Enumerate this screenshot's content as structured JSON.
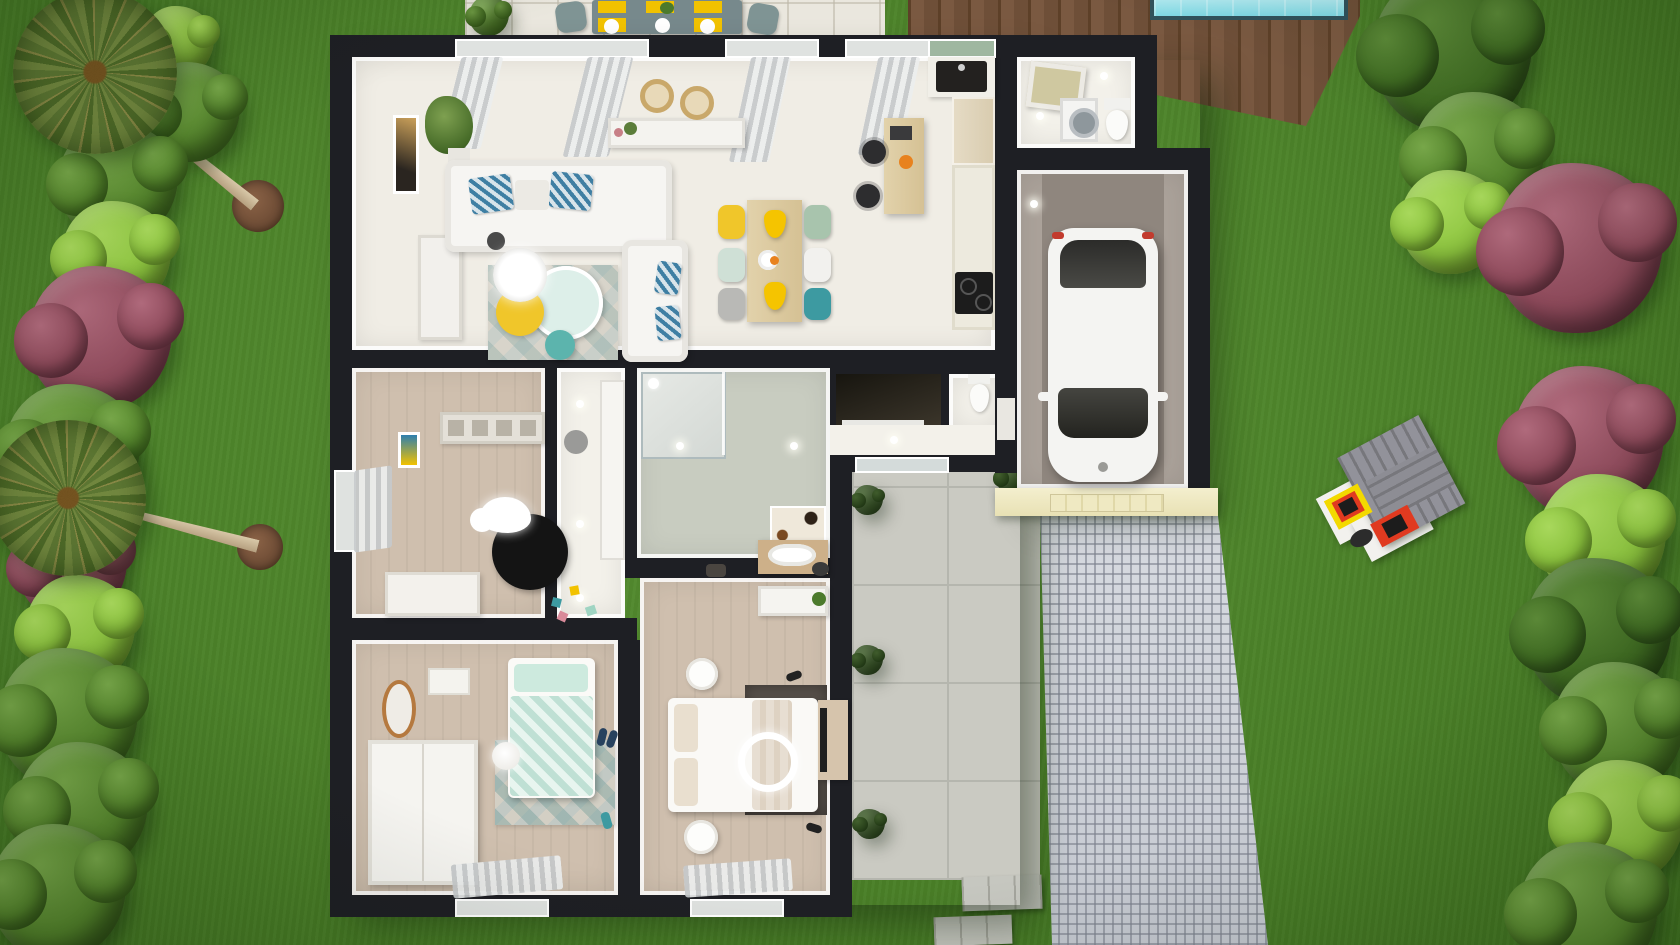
{
  "scene": {
    "type": "3d-floorplan-aerial-render",
    "palette": {
      "grass": "#4d8a26",
      "wall": "#1e1f24",
      "floor_white": "#f0ede5",
      "floor_wood": "#cfbfae",
      "floor_bath": "#c8ccc0",
      "garage_floor": "#a79e96",
      "terrace": "#cacac2",
      "cobble": "#ccd0d7",
      "deck": "#7a5941",
      "pool": "#85dbe7",
      "cream_facade": "#f1ecca",
      "accent_yellow": "#f2c200",
      "accent_teal": "#3f9aa1",
      "accent_mint": "#bfe0d4",
      "rug_dark": "#57504a",
      "rug_black": "#141414",
      "tree_light": "#8cc43e",
      "tree_green": "#55862c",
      "tree_dark": "#3f6b22",
      "tree_red": "#8e4a5b",
      "palm": "#67803a",
      "mulch": "#6f4d36",
      "car": "#f4f4f2",
      "playhouse_roof": "#8b8b90",
      "playhouse_window": "#f3d900",
      "playhouse_door": "#e03a20"
    },
    "house": {
      "wall_color": "#1e1f24",
      "rooms": [
        {
          "name": "living-room",
          "floor": "#f0ede5",
          "items": [
            "sofa",
            "sofa-2",
            "rug",
            "coffee-tables",
            "wall-shelf",
            "plant",
            "picture"
          ]
        },
        {
          "name": "dining-area",
          "floor": "#f0ede5",
          "items": [
            "wood-table",
            "6-chairs",
            "yellow-pendants",
            "console"
          ]
        },
        {
          "name": "kitchen",
          "floor": "#f0ede5",
          "items": [
            "black-sink",
            "counter",
            "cooktop",
            "desk",
            "office-chairs"
          ]
        },
        {
          "name": "laundry",
          "floor": "#efede8",
          "items": [
            "washing-machine",
            "toilet",
            "skylight"
          ]
        },
        {
          "name": "garage",
          "floor": "#a79e96",
          "items": [
            "white-car"
          ]
        },
        {
          "name": "entry-hall",
          "floor": "#f3f1ea",
          "items": [
            "glass-door"
          ]
        },
        {
          "name": "cellar",
          "floor": "#2a2620",
          "items": [
            "sliding-door"
          ]
        },
        {
          "name": "wc",
          "floor": "#e9e7e1",
          "items": [
            "toilet"
          ]
        },
        {
          "name": "corridor",
          "floor": "#f2f0ea",
          "items": [
            "closet"
          ]
        },
        {
          "name": "kids-bedroom",
          "floor": "#cfbfae",
          "items": [
            "black-round-rug",
            "cloud-crib",
            "dresser",
            "toys",
            "shelf"
          ]
        },
        {
          "name": "bathroom",
          "floor": "#c8ccc0",
          "items": [
            "shower",
            "vanity",
            "art-panel"
          ]
        },
        {
          "name": "bedroom",
          "floor": "#cfbfae",
          "items": [
            "mint-bed",
            "triangle-rug",
            "wardrobe",
            "copper-mirror"
          ]
        },
        {
          "name": "master-bedroom",
          "floor": "#cfbfae",
          "items": [
            "double-bed",
            "dark-rug",
            "tv-stand",
            "nightstands",
            "console"
          ]
        }
      ]
    },
    "exterior": {
      "patio_dining": {
        "table": "#77898c",
        "placemats": 6,
        "placemat_color": "#f2c200",
        "plates": "#ffffff",
        "chairs": "#7f9494"
      },
      "pool": {
        "water": "#85dbe7",
        "coping": "#30525c"
      },
      "deck": {
        "color": "#7a5941"
      },
      "driveway": {
        "style": "cobblestone",
        "color": "#ccd0d7"
      },
      "playhouse": {
        "roof": "#8b8b90",
        "walls": "#ffffff",
        "window": "#f3d900",
        "door": "#e03a20"
      },
      "car": {
        "color": "#f4f4f2",
        "location": "garage"
      }
    },
    "palms": [
      {
        "x": 95,
        "y": 72,
        "r": 82
      },
      {
        "x": 68,
        "y": 498,
        "r": 78
      }
    ],
    "trunks": [
      {
        "x1": 100,
        "y1": 80,
        "x2": 255,
        "y2": 205
      },
      {
        "x1": 75,
        "y1": 498,
        "x2": 258,
        "y2": 546
      }
    ],
    "mulch": [
      {
        "x": 258,
        "y": 206,
        "r": 26
      },
      {
        "x": 260,
        "y": 547,
        "r": 23
      }
    ],
    "trees": [
      {
        "type": "light",
        "x": 178,
        "y": 42,
        "r": 36
      },
      {
        "type": "green",
        "x": 190,
        "y": 112,
        "r": 50
      },
      {
        "type": "green",
        "x": 118,
        "y": 182,
        "r": 60
      },
      {
        "type": "light",
        "x": 116,
        "y": 256,
        "r": 55
      },
      {
        "type": "red",
        "x": 100,
        "y": 338,
        "r": 72
      },
      {
        "type": "green",
        "x": 72,
        "y": 452,
        "r": 68
      },
      {
        "type": "red",
        "x": 72,
        "y": 566,
        "r": 55
      },
      {
        "type": "light",
        "x": 80,
        "y": 630,
        "r": 55
      },
      {
        "type": "green",
        "x": 68,
        "y": 718,
        "r": 70
      },
      {
        "type": "green",
        "x": 82,
        "y": 808,
        "r": 66
      },
      {
        "type": "green",
        "x": 58,
        "y": 892,
        "r": 68
      },
      {
        "type": "dark",
        "x": 1452,
        "y": 52,
        "r": 80
      },
      {
        "type": "green",
        "x": 1478,
        "y": 158,
        "r": 66
      },
      {
        "type": "light",
        "x": 1452,
        "y": 222,
        "r": 52
      },
      {
        "type": "red",
        "x": 1578,
        "y": 248,
        "r": 85
      },
      {
        "type": "red",
        "x": 1588,
        "y": 442,
        "r": 76
      },
      {
        "type": "light",
        "x": 1602,
        "y": 538,
        "r": 64
      },
      {
        "type": "dark",
        "x": 1598,
        "y": 632,
        "r": 74
      },
      {
        "type": "green",
        "x": 1618,
        "y": 728,
        "r": 66
      },
      {
        "type": "light",
        "x": 1622,
        "y": 822,
        "r": 62
      },
      {
        "type": "green",
        "x": 1588,
        "y": 912,
        "r": 70
      },
      {
        "type": "green",
        "x": 489,
        "y": 16,
        "r": 20
      }
    ],
    "terrace_bushes": [
      {
        "x": 868,
        "y": 500,
        "r": 15
      },
      {
        "x": 868,
        "y": 660,
        "r": 15
      },
      {
        "x": 870,
        "y": 824,
        "r": 15
      },
      {
        "x": 1012,
        "y": 478,
        "r": 16
      }
    ],
    "stepping_stones": [
      {
        "x": 962,
        "y": 876,
        "w": 80,
        "h": 34,
        "rot": -2
      },
      {
        "x": 934,
        "y": 916,
        "w": 78,
        "h": 29,
        "rot": -2
      }
    ]
  }
}
